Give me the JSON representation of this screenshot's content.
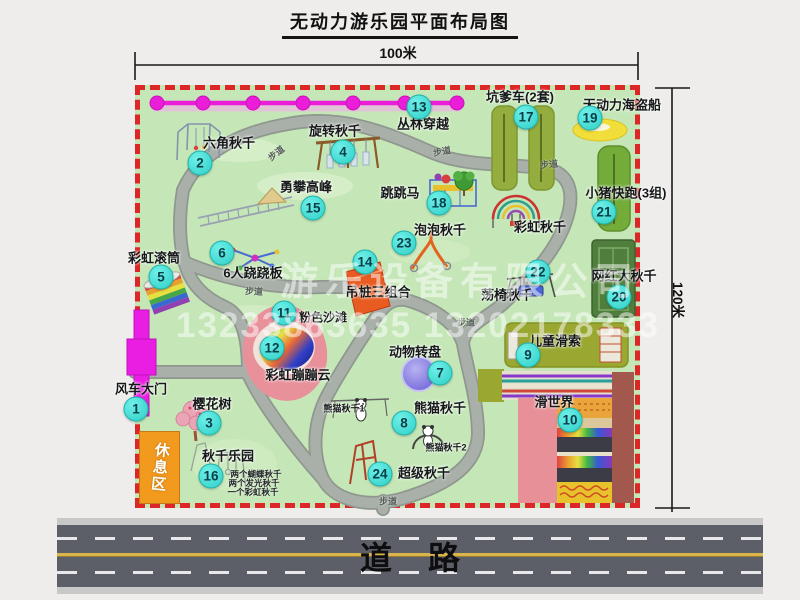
{
  "window": {
    "title": "无动力游乐园平面布局图"
  },
  "dimensions": {
    "top": "100米",
    "right": "120米"
  },
  "road": {
    "label": "道路"
  },
  "watermark": {
    "line1": "游乐设备有限公司",
    "line2": "13233863635 13202178333"
  },
  "rest_area": {
    "label": "休息区"
  },
  "colors": {
    "map_green": "#c5e7b7",
    "border_red": "#dd2626",
    "walkway_gray": "#a9b0a9",
    "badge_cyan": "#2ecfc7",
    "zipline_magenta": "#ea1ed8",
    "gate_magenta": "#ea1ee2",
    "rest_area_orange": "#f29a1e",
    "road_asphalt": "#5d5f68",
    "road_yellow": "#d9b54a",
    "pink_beach": "#e8919b",
    "turntable_purple": "#6c5ed8",
    "pirate_ship_yellow": "#f2de3a"
  },
  "map": {
    "attractions": [
      {
        "id": "windmill-gate",
        "num": "1",
        "label": "风车大门",
        "lx": 141,
        "ly": 388,
        "bx": 136,
        "by": 409
      },
      {
        "id": "hexagon-swing",
        "num": "2",
        "label": "六角秋千",
        "lx": 229,
        "ly": 142,
        "bx": 200,
        "by": 163
      },
      {
        "id": "cherry-tree",
        "num": "3",
        "label": "樱花树",
        "lx": 212,
        "ly": 403,
        "bx": 209,
        "by": 423
      },
      {
        "id": "rotating-swing",
        "num": "4",
        "label": "旋转秋千",
        "lx": 335,
        "ly": 130,
        "bx": 343,
        "by": 152
      },
      {
        "id": "rainbow-roller",
        "num": "5",
        "label": "彩虹滚筒",
        "lx": 154,
        "ly": 257,
        "bx": 161,
        "by": 277
      },
      {
        "id": "six-person-seesaw",
        "num": "6",
        "label": "6人跷跷板",
        "lx": 253,
        "ly": 272,
        "bx": 222,
        "by": 253
      },
      {
        "id": "animal-turntable",
        "num": "7",
        "label": "动物转盘",
        "lx": 415,
        "ly": 351,
        "bx": 440,
        "by": 373
      },
      {
        "id": "panda-swing",
        "num": "8",
        "label": "熊猫秋千",
        "lx": 440,
        "ly": 407,
        "bx": 404,
        "by": 423
      },
      {
        "id": "kids-zipline",
        "num": "9",
        "label": "儿童滑索",
        "lx": 555,
        "ly": 340,
        "bx": 528,
        "by": 355
      },
      {
        "id": "slide-world",
        "num": "10",
        "label": "滑世界",
        "lx": 554,
        "ly": 401,
        "bx": 570,
        "by": 420
      },
      {
        "id": "pink-beach",
        "num": "11",
        "label": "粉色沙滩",
        "lx": 323,
        "ly": 317,
        "bx": 284,
        "by": 313,
        "fs": 12
      },
      {
        "id": "rainbow-bouncing-cloud",
        "num": "12",
        "label": "彩虹蹦蹦云",
        "lx": 298,
        "ly": 374,
        "bx": 272,
        "by": 348
      },
      {
        "id": "jungle-crossing",
        "num": "13",
        "label": "丛林穿越",
        "lx": 423,
        "ly": 123,
        "bx": 419,
        "by": 107
      },
      {
        "id": "hanging-pile-combo",
        "num": "14",
        "label": "吊桩三组合",
        "lx": 378,
        "ly": 291,
        "bx": 365,
        "by": 262
      },
      {
        "id": "peak-climbing",
        "num": "15",
        "label": "勇攀高峰",
        "lx": 306,
        "ly": 186,
        "bx": 313,
        "by": 208
      },
      {
        "id": "swing-paradise",
        "num": "16",
        "label": "秋千乐园",
        "lx": 228,
        "ly": 455,
        "bx": 211,
        "by": 476
      },
      {
        "id": "pit-car",
        "num": "17",
        "label": "坑爹车(2套)",
        "lx": 520,
        "ly": 96,
        "bx": 526,
        "by": 117
      },
      {
        "id": "jumping-horse",
        "num": "18",
        "label": "跳跳马",
        "lx": 400,
        "ly": 192,
        "bx": 439,
        "by": 203
      },
      {
        "id": "pirate-ship",
        "num": "19",
        "label": "无动力海盗船",
        "lx": 622,
        "ly": 104,
        "bx": 590,
        "by": 118
      },
      {
        "id": "big-net-swing",
        "num": "20",
        "label": "网红大秋千",
        "lx": 624,
        "ly": 275,
        "bx": 619,
        "by": 297
      },
      {
        "id": "piggy-run",
        "num": "21",
        "label": "小猪快跑(3组)",
        "lx": 626,
        "ly": 192,
        "bx": 604,
        "by": 212
      },
      {
        "id": "chair-swing",
        "num": "22",
        "label": "荡椅秋千",
        "lx": 507,
        "ly": 294,
        "bx": 538,
        "by": 272
      },
      {
        "id": "bubble-swing",
        "num": "23",
        "label": "泡泡秋千",
        "lx": 440,
        "ly": 229,
        "bx": 404,
        "by": 243
      },
      {
        "id": "super-swing",
        "num": "24",
        "label": "超级秋千",
        "lx": 424,
        "ly": 472,
        "bx": 380,
        "by": 474
      },
      {
        "id": "rainbow-swing",
        "label": "彩虹秋千",
        "lx": 540,
        "ly": 226
      },
      {
        "id": "panda-swing-1",
        "label": "熊猫秋千1",
        "lx": 344,
        "ly": 408,
        "fs": 9
      },
      {
        "id": "panda-swing-2",
        "label": "熊猫秋千2",
        "lx": 446,
        "ly": 447,
        "fs": 9
      }
    ],
    "path_labels": [
      {
        "text": "步道",
        "x": 276,
        "y": 153,
        "rot": -38
      },
      {
        "text": "步道",
        "x": 442,
        "y": 151,
        "rot": -10
      },
      {
        "text": "步道",
        "x": 549,
        "y": 164,
        "rot": -6
      },
      {
        "text": "步道",
        "x": 254,
        "y": 291,
        "rot": 3
      },
      {
        "text": "步道",
        "x": 466,
        "y": 322,
        "rot": 0
      },
      {
        "text": "步道",
        "x": 388,
        "y": 501,
        "rot": 0
      }
    ],
    "swing_paradise_notes": [
      {
        "text": "两个蝴蝶秋千",
        "x": 256,
        "y": 474
      },
      {
        "text": "两个发光秋千",
        "x": 254,
        "y": 483
      },
      {
        "text": "一个彩虹秋千",
        "x": 253,
        "y": 492
      }
    ]
  }
}
